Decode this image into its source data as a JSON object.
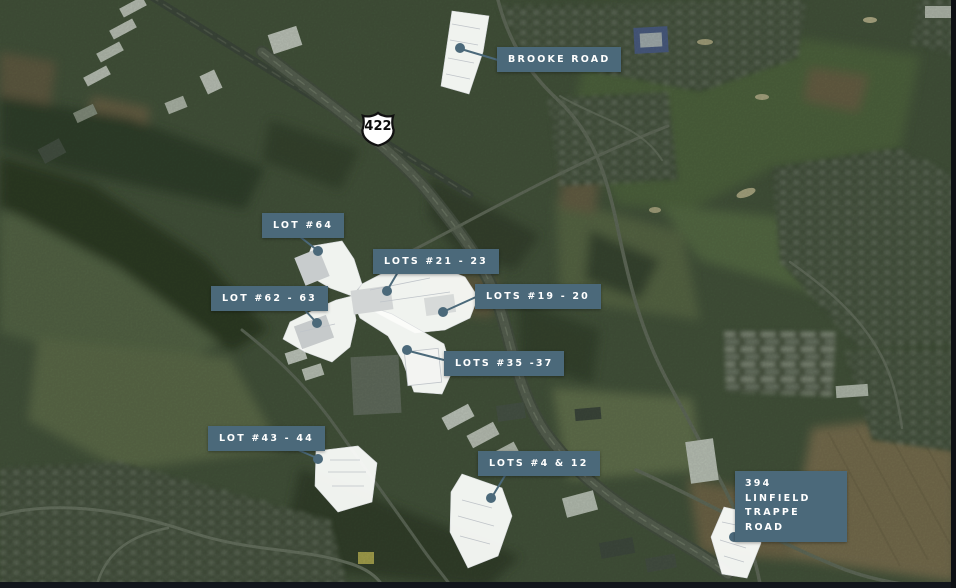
{
  "theme": {
    "accent": "#4b697a",
    "label_text": "#ffffff",
    "parcel_fill": "#fbfcfa",
    "map_base": "#45523c"
  },
  "map": {
    "type": "aerial-satellite-map-with-lot-callouts",
    "route_shield": {
      "number": "422"
    },
    "labels": [
      {
        "id": "brooke-road",
        "text": "BROOKE ROAD"
      },
      {
        "id": "lot-64",
        "text": "LOT #64"
      },
      {
        "id": "lots-21-23",
        "text": "LOTS #21 - 23"
      },
      {
        "id": "lot-62-63",
        "text": "LOT #62 - 63"
      },
      {
        "id": "lots-19-20",
        "text": "LOTS #19 - 20"
      },
      {
        "id": "lots-35-37",
        "text": "LOTS #35 -37"
      },
      {
        "id": "lot-43-44",
        "text": "LOT #43 - 44"
      },
      {
        "id": "lots-4-12",
        "text": "LOTS #4 & 12"
      },
      {
        "id": "394-linfield-trappe-road",
        "text": "394 LINFIELD TRAPPE ROAD",
        "lines": [
          "394 LINFIELD",
          "TRAPPE ROAD"
        ]
      }
    ]
  }
}
